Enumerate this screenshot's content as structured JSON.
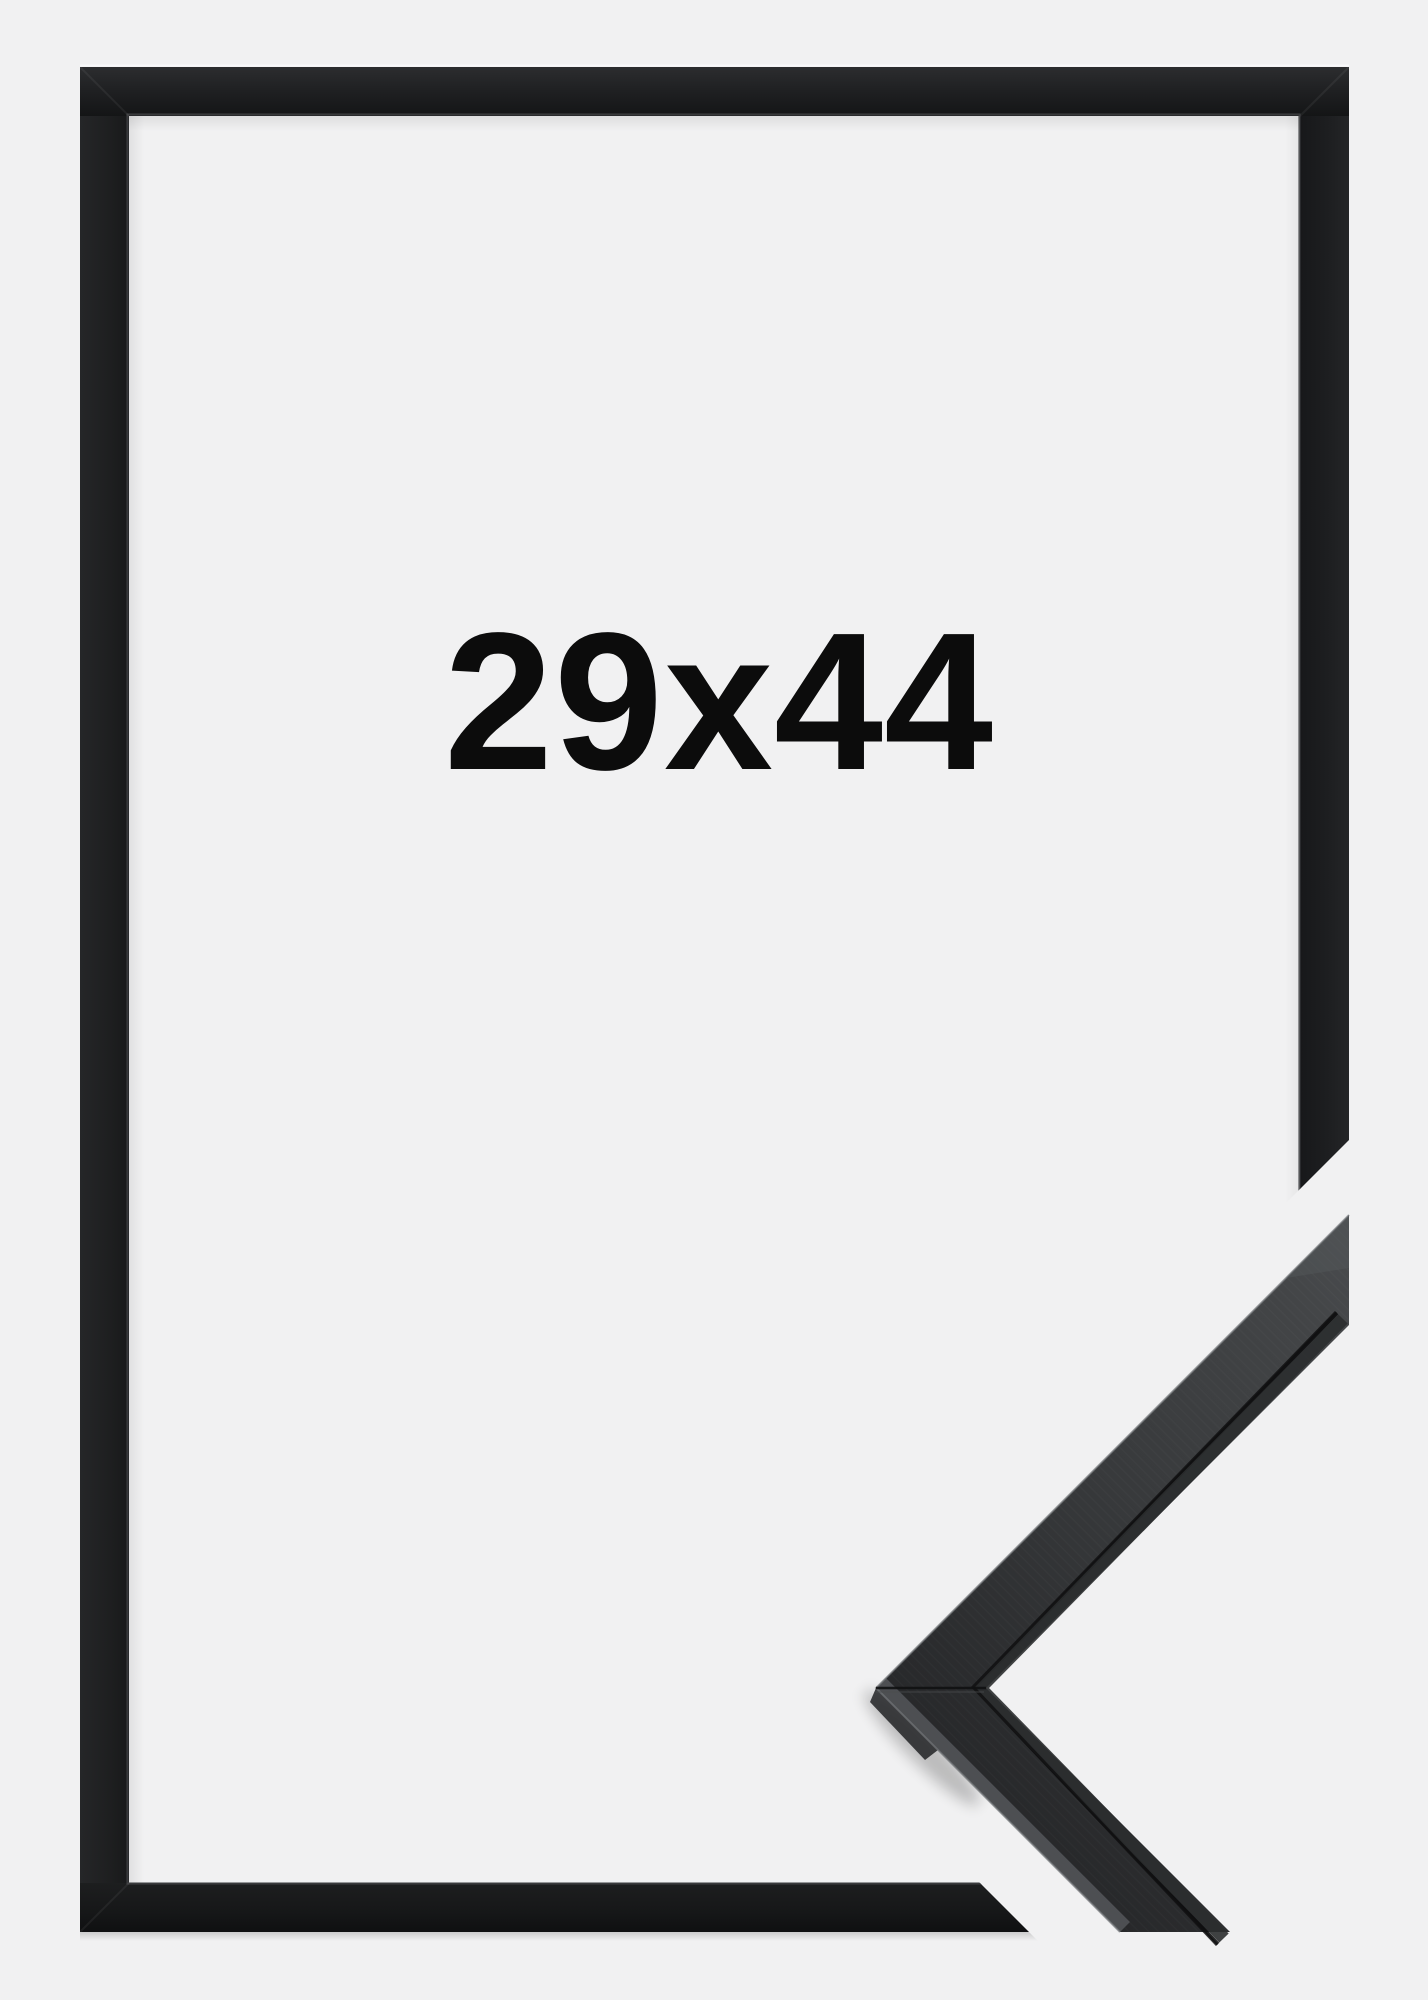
{
  "product": {
    "size_label": "29x44",
    "description": "Black picture frame product photo with corner profile detail",
    "background_color": "#f1f1f2",
    "frame_color": "#1d1e1f",
    "label_color": "#0c0c0c",
    "detail_face_color": "#3a3c3e"
  }
}
